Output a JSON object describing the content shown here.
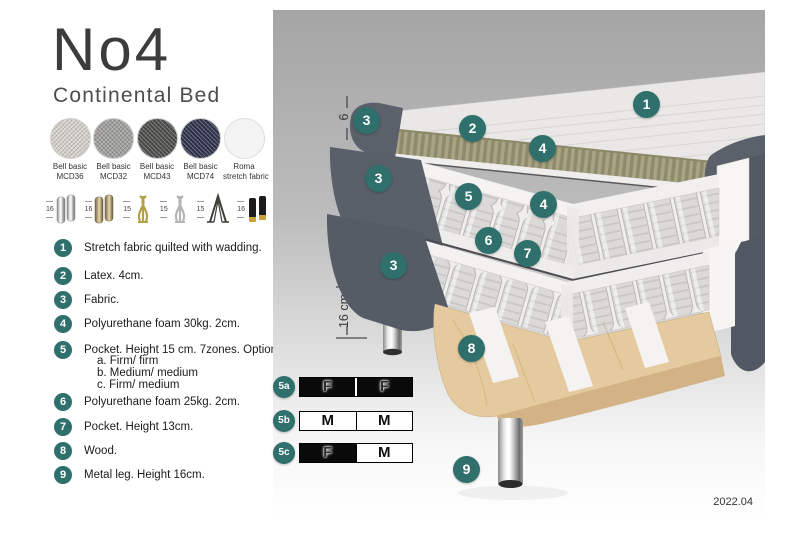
{
  "title": "No4",
  "subtitle": "Continental Bed",
  "fabrics": [
    {
      "name_line1": "Bell basic",
      "name_line2": "MCD36",
      "color": "#d6d3cc"
    },
    {
      "name_line1": "Bell basic",
      "name_line2": "MCD32",
      "color": "#a09f9d"
    },
    {
      "name_line1": "Bell basic",
      "name_line2": "MCD43",
      "color": "#4e4e4c"
    },
    {
      "name_line1": "Bell basic",
      "name_line2": "MCD74",
      "color": "#30344d"
    },
    {
      "name_line1": "Roma",
      "name_line2": "stretch fabric",
      "color": "#f4f4f4"
    }
  ],
  "legs": [
    {
      "height": "16",
      "type": "chrome-cylinder"
    },
    {
      "height": "16",
      "type": "bronze-cylinder"
    },
    {
      "height": "15",
      "type": "gold-twist"
    },
    {
      "height": "15",
      "type": "silver-twist"
    },
    {
      "height": "15",
      "type": "hairpin"
    },
    {
      "height": "16",
      "type": "black-gold-cylinder"
    }
  ],
  "parts": [
    {
      "num": "1",
      "text": "Stretch fabric quilted with wadding."
    },
    {
      "num": "2",
      "text": "Latex. 4cm."
    },
    {
      "num": "3",
      "text": "Fabric."
    },
    {
      "num": "4",
      "text": "Polyurethane foam 30kg. 2cm."
    },
    {
      "num": "5",
      "text": "Pocket. Height 15 cm. 7zones. Option:",
      "options": [
        "a. Firm/ firm",
        "b. Medium/ medium",
        "c. Firm/ medium"
      ]
    },
    {
      "num": "6",
      "text": "Polyurethane foam 25kg. 2cm."
    },
    {
      "num": "7",
      "text": "Pocket. Height 13cm."
    },
    {
      "num": "8",
      "text": "Wood."
    },
    {
      "num": "9",
      "text": "Metal leg. Height 16cm."
    }
  ],
  "dimensions": [
    "6",
    "19 cm",
    "27 cm",
    "16 cm"
  ],
  "callouts": [
    "1",
    "2",
    "3",
    "4",
    "3",
    "5",
    "4",
    "6",
    "7",
    "3",
    "8",
    "9"
  ],
  "firmness": [
    {
      "label": "5a",
      "cells": [
        {
          "letter": "F",
          "style": "dark"
        },
        {
          "letter": "F",
          "style": "dark"
        }
      ]
    },
    {
      "label": "5b",
      "cells": [
        {
          "letter": "M",
          "style": "light"
        },
        {
          "letter": "M",
          "style": "light"
        }
      ]
    },
    {
      "label": "5c",
      "cells": [
        {
          "letter": "F",
          "style": "dark"
        },
        {
          "letter": "M",
          "style": "light"
        }
      ]
    }
  ],
  "version": "2022.04",
  "colors": {
    "accent_teal": "#2f6f6c",
    "dark_fabric": "#5a606a",
    "latex_olive": "#a8a486",
    "wood_tan": "#e4ca9e"
  }
}
